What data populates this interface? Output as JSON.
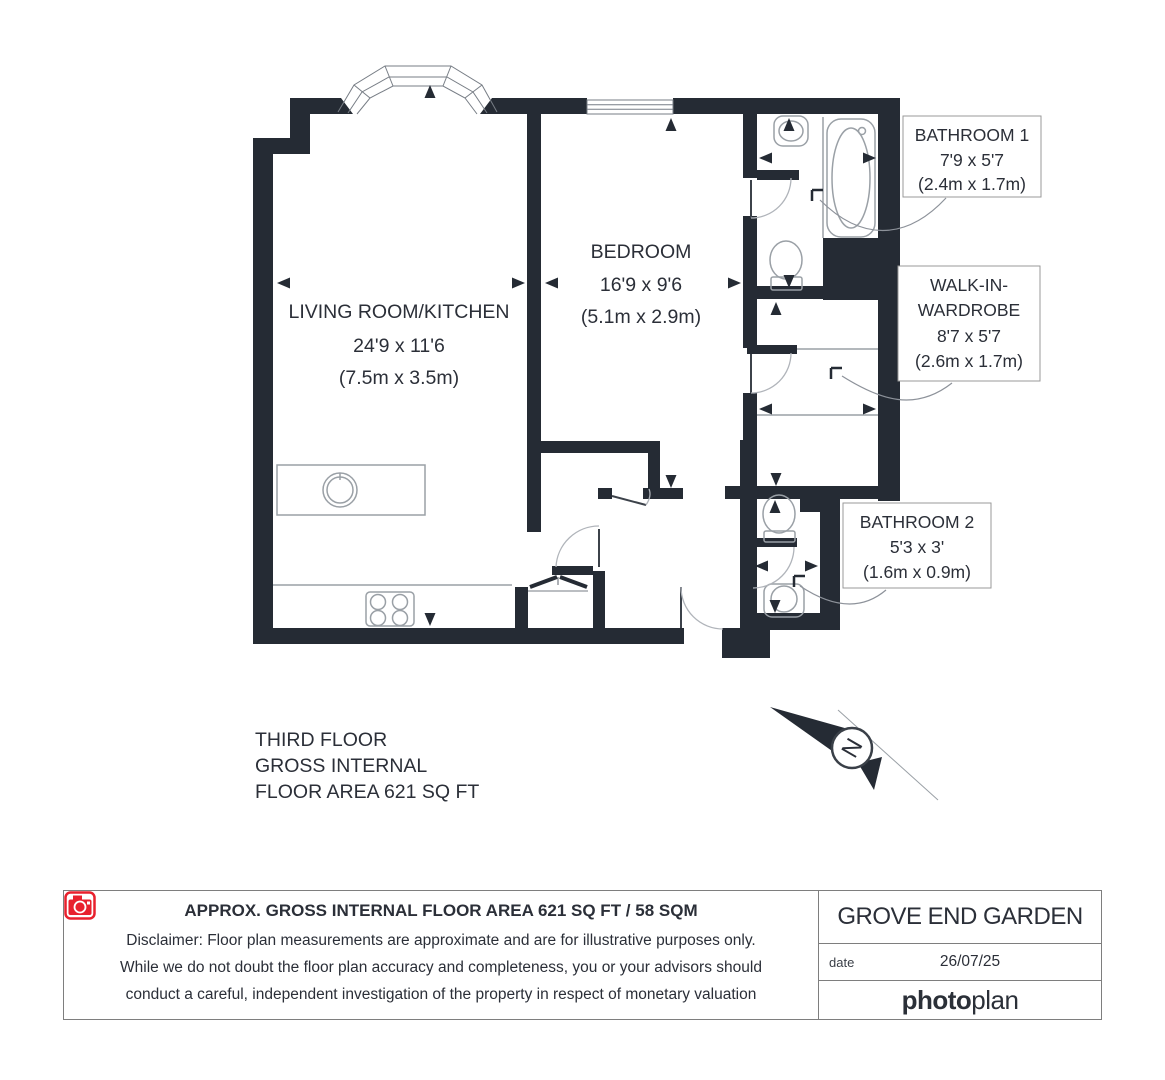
{
  "plan": {
    "rooms": {
      "living": {
        "name": "LIVING ROOM/KITCHEN",
        "imperial": "24'9 x 11'6",
        "metric": "(7.5m x 3.5m)"
      },
      "bedroom": {
        "name": "BEDROOM",
        "imperial": "16'9 x 9'6",
        "metric": "(5.1m x 2.9m)"
      },
      "bathroom1": {
        "name": "BATHROOM 1",
        "imperial": "7'9 x 5'7",
        "metric": "(2.4m x 1.7m)"
      },
      "wardrobe": {
        "name_line1": "WALK-IN-",
        "name_line2": "WARDROBE",
        "imperial": "8'7 x 5'7",
        "metric": "(2.6m x 1.7m)"
      },
      "bathroom2": {
        "name": "BATHROOM 2",
        "imperial": "5'3 x 3'",
        "metric": "(1.6m x 0.9m)"
      }
    },
    "floor_note": {
      "line1": "THIRD FLOOR",
      "line2": "GROSS INTERNAL",
      "line3": "FLOOR AREA 621 SQ FT"
    },
    "compass_letter": "N"
  },
  "footer": {
    "area_title": "APPROX. GROSS INTERNAL FLOOR AREA 621 SQ FT / 58 SQM",
    "disclaimer_line1": "Disclaimer: Floor plan measurements are approximate and are for illustrative purposes only.",
    "disclaimer_line2": "While we do not doubt the floor plan accuracy and completeness, you or your advisors should",
    "disclaimer_line3": "conduct a careful, independent investigation of the property in respect of monetary valuation",
    "property_name": "GROVE END GARDEN",
    "date_label": "date",
    "date_value": "26/07/25",
    "brand": {
      "part1": "photo",
      "part2": "plan"
    }
  },
  "colors": {
    "wall": "#252b34",
    "accent_red": "#e8212d",
    "fixture_line": "#9aa0a6",
    "text": "#2b2f38"
  }
}
